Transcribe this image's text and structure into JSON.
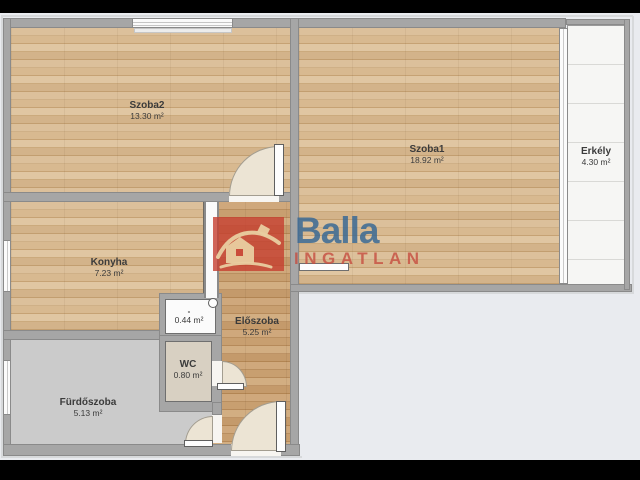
{
  "title": "Apartment floor plan",
  "rooms": [
    {
      "id": "szoba2",
      "name": "Szoba2",
      "area": "13.30 m²"
    },
    {
      "id": "szoba1",
      "name": "Szoba1",
      "area": "18.92 m²"
    },
    {
      "id": "erkely",
      "name": "Erkély",
      "area": "4.30 m²"
    },
    {
      "id": "konyha",
      "name": "Konyha",
      "area": "7.23 m²"
    },
    {
      "id": "eloszoba",
      "name": "Előszoba",
      "area": "5.25 m²"
    },
    {
      "id": "kamra",
      "name": "-",
      "area": "0.44 m²"
    },
    {
      "id": "wc",
      "name": "WC",
      "area": "0.80 m²"
    },
    {
      "id": "furdoszoba",
      "name": "Fürdőszoba",
      "area": "5.13 m²"
    }
  ],
  "watermark": {
    "brand": "Balla",
    "sub": "INGATLAN"
  },
  "colors": {
    "background": "#e9ebef",
    "letterbox": "#000000",
    "wall": "#a6a6a6",
    "wood": "#d6ba93",
    "wood_dark": "#c9a377",
    "bathroom_floor": "#cbcbcb",
    "wc_floor": "#d8d0c2",
    "balcony_floor": "#f6f6f4",
    "door_swing": "#ece4d4",
    "logo_red": "#c63e30",
    "logo_blue": "#3a6894"
  }
}
